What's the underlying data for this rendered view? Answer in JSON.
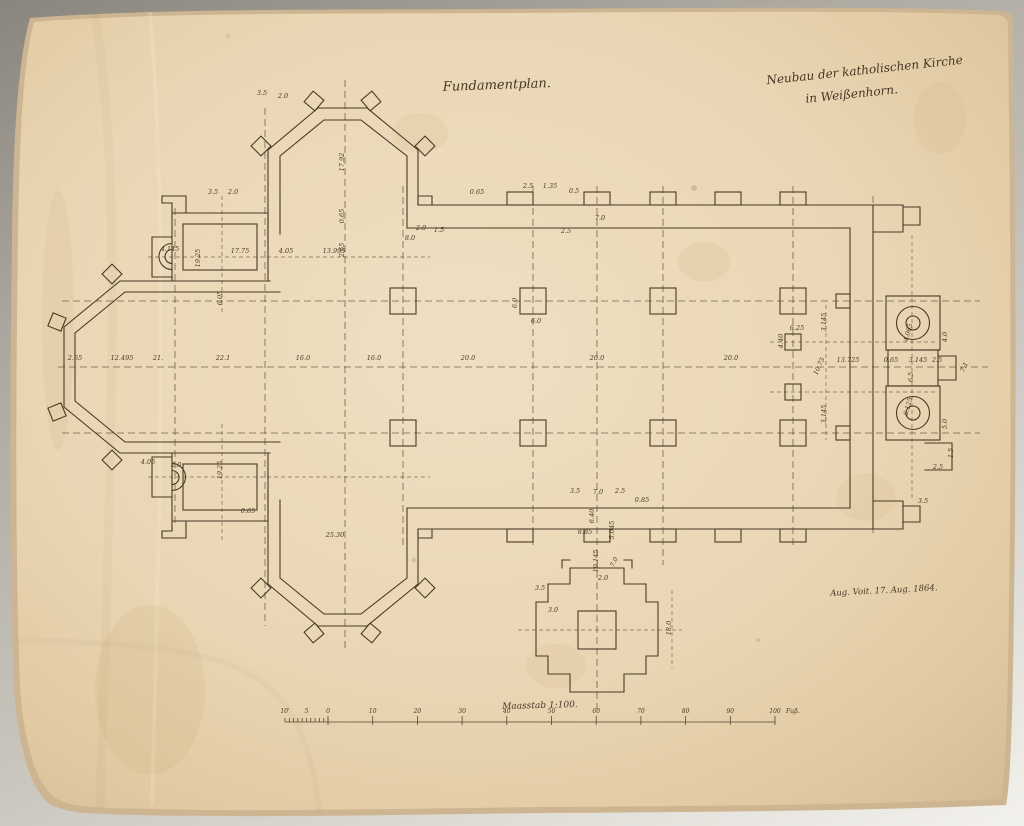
{
  "document": {
    "kind": "scanned architectural foundation plan, hand drawn, 1864",
    "titles": {
      "plan_type": "Fundamentplan.",
      "project_line1": "Neubau der katholischen Kirche",
      "project_line2": "in Weißenhorn.",
      "signature": "Aug. Voit. 17. Aug. 1864."
    },
    "colors": {
      "paper": "#e9d6b4",
      "paper_edge": "#d3bb97",
      "ink": "#4a3926",
      "scan_background": "#a8a49c"
    }
  },
  "scale_bar": {
    "label": "Maasstab 1:100.",
    "unit_label": "Fuß.",
    "left_labels": [
      "10'",
      "5",
      "0"
    ],
    "major_labels": [
      "10",
      "20",
      "30",
      "40",
      "50",
      "60",
      "70",
      "80",
      "90",
      "100"
    ]
  },
  "plan_features": [
    "west apse with corner buttresses",
    "two sacristy rooms with semicircular niches",
    "north transept chapel (polygonal)",
    "south transept chapel (polygonal)",
    "nave with two rows of square pier foundations",
    "east facade with two circular stair towers and portal",
    "detached cruciform tower foundation",
    "dashed centerline axis grid",
    "scale bar in feet"
  ],
  "annotations": [
    [
      75,
      360,
      "2.65",
      0
    ],
    [
      122,
      360,
      "12.495",
      0
    ],
    [
      158,
      360,
      "21.",
      0
    ],
    [
      223,
      360,
      "22.1",
      0
    ],
    [
      303,
      360,
      "16.0",
      0
    ],
    [
      374,
      360,
      "16.0",
      0
    ],
    [
      468,
      360,
      "20.0",
      0
    ],
    [
      597,
      360,
      "20.0",
      0
    ],
    [
      731,
      360,
      "20.0",
      0
    ],
    [
      821,
      367,
      "10.75",
      -65
    ],
    [
      848,
      362,
      "13.725",
      0
    ],
    [
      891,
      362,
      "0.65",
      0
    ],
    [
      918,
      362,
      "3.145",
      0
    ],
    [
      937,
      362,
      "2.5",
      0
    ],
    [
      966,
      368,
      "7.1",
      -65
    ],
    [
      170,
      251,
      "4.145",
      0
    ],
    [
      240,
      253,
      "17.75",
      0
    ],
    [
      286,
      253,
      "4.05",
      0
    ],
    [
      334,
      253,
      "13.995",
      0
    ],
    [
      200,
      258,
      "19.25",
      -90
    ],
    [
      222,
      298,
      "6.05",
      -90
    ],
    [
      213,
      194,
      "3.5",
      0
    ],
    [
      233,
      194,
      "2.0",
      0
    ],
    [
      262,
      95,
      "3.5",
      0
    ],
    [
      283,
      98,
      "2.0",
      0
    ],
    [
      344,
      162,
      "17.92",
      -90
    ],
    [
      344,
      216,
      "0.65",
      -90
    ],
    [
      344,
      250,
      "2.65",
      -90
    ],
    [
      421,
      230,
      "2.0",
      0
    ],
    [
      439,
      232,
      "1.5",
      0
    ],
    [
      410,
      240,
      "8.0",
      0
    ],
    [
      477,
      194,
      "0.65",
      0
    ],
    [
      528,
      188,
      "2.5",
      0
    ],
    [
      550,
      188,
      "1.35",
      0
    ],
    [
      574,
      193,
      "0.5",
      0
    ],
    [
      600,
      220,
      "7.0",
      0
    ],
    [
      566,
      233,
      "2.5",
      0
    ],
    [
      517,
      303,
      "6.0",
      -90
    ],
    [
      536,
      323,
      "6.0",
      0
    ],
    [
      148,
      464,
      "4.05",
      0
    ],
    [
      176,
      467,
      "2.0",
      0
    ],
    [
      222,
      470,
      "19.25",
      -90
    ],
    [
      248,
      513,
      "0.65",
      0
    ],
    [
      335,
      537,
      "25.30",
      0
    ],
    [
      575,
      493,
      "3.5",
      0
    ],
    [
      598,
      494,
      "7.0",
      0
    ],
    [
      620,
      493,
      "2.5",
      0
    ],
    [
      642,
      502,
      "0.85",
      0
    ],
    [
      594,
      516,
      "6.40",
      -90
    ],
    [
      585,
      534,
      "8.85",
      0
    ],
    [
      614,
      530,
      "5.045",
      -90
    ],
    [
      598,
      561,
      "10.145",
      -90
    ],
    [
      616,
      563,
      "7.0",
      -65
    ],
    [
      603,
      580,
      "2.0",
      0
    ],
    [
      671,
      628,
      "18.0",
      -90
    ],
    [
      540,
      590,
      "3.5",
      0
    ],
    [
      553,
      612,
      "3.0",
      0
    ],
    [
      826,
      322,
      "3.145",
      -90
    ],
    [
      826,
      414,
      "3.145",
      -90
    ],
    [
      797,
      330,
      "6.25",
      0
    ],
    [
      783,
      341,
      "4.40",
      -90
    ],
    [
      913,
      377,
      "6.5",
      -90
    ],
    [
      910,
      333,
      "4.065",
      -75
    ],
    [
      910,
      407,
      "6.125",
      -75
    ],
    [
      947,
      337,
      "4.0",
      -90
    ],
    [
      947,
      424,
      "5.0",
      -90
    ],
    [
      938,
      469,
      "2.5",
      0
    ],
    [
      923,
      503,
      "3.5",
      0
    ],
    [
      953,
      453,
      "1.5",
      -90
    ]
  ]
}
